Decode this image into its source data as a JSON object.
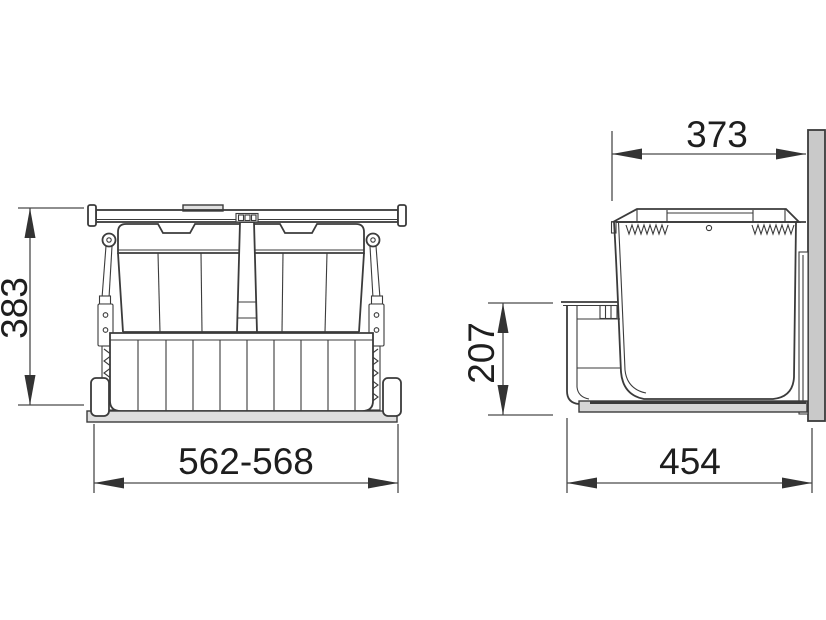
{
  "diagram": {
    "views": {
      "front": {
        "dimensions": {
          "height": {
            "label": "383",
            "orientation": "vertical"
          },
          "width": {
            "label": "562-568",
            "orientation": "horizontal"
          }
        }
      },
      "side": {
        "dimensions": {
          "top_width": {
            "label": "373",
            "orientation": "horizontal"
          },
          "front_height": {
            "label": "207",
            "orientation": "vertical"
          },
          "base_depth": {
            "label": "454",
            "orientation": "horizontal"
          }
        }
      }
    },
    "colors": {
      "background": "#ffffff",
      "line": "#3b3b3b",
      "text": "#1e1e1e",
      "panel_fill": "#c9c9c9",
      "rail_fill": "#ededed",
      "tray_fill": "#d6d6d6"
    }
  }
}
